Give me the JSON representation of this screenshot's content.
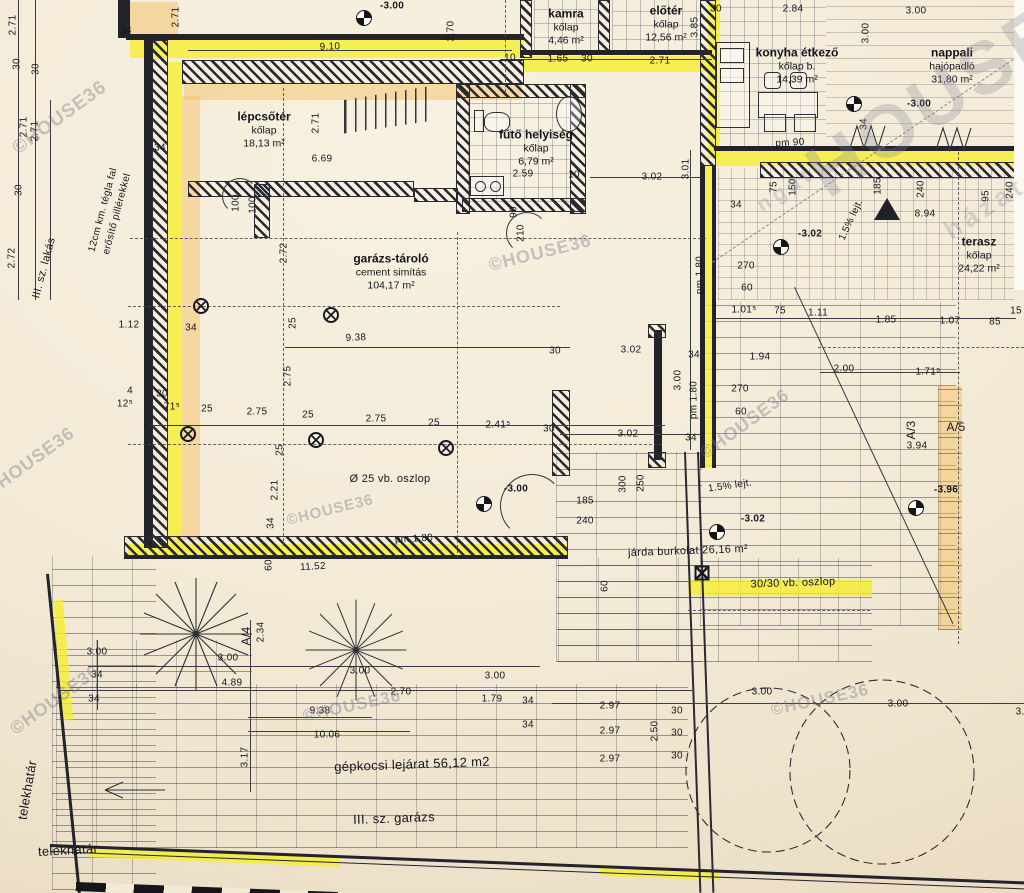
{
  "drawing": {
    "type": "architectural floor plan",
    "watermark_brand": "©HOUSE36",
    "accent_highlight": "#f6ee2c",
    "accent_band": "#f3bc58",
    "paper": "#f3ead6"
  },
  "rooms": [
    {
      "id": "kamra",
      "lines": [
        "kamra",
        "kőlap",
        "4,46 m²"
      ],
      "x": 566,
      "y": 27
    },
    {
      "id": "eloter",
      "lines": [
        "előtér",
        "kőlap",
        "12,56 m²"
      ],
      "x": 666,
      "y": 24
    },
    {
      "id": "konyha",
      "lines": [
        "konyha étkező",
        "kőlap b.",
        "14,39 m²"
      ],
      "x": 797,
      "y": 66
    },
    {
      "id": "nappali",
      "lines": [
        "nappali",
        "hajópadló",
        "31,80 m²"
      ],
      "x": 952,
      "y": 66
    },
    {
      "id": "lepcsoter",
      "lines": [
        "lépcsőtér",
        "kőlap",
        "18,13 m²"
      ],
      "x": 264,
      "y": 130
    },
    {
      "id": "futo",
      "lines": [
        "fűtő helyiség",
        "kőlap",
        "6,79 m²"
      ],
      "x": 536,
      "y": 148
    },
    {
      "id": "garazs",
      "lines": [
        "garázs-tároló",
        "cement simítás",
        "104,17 m²"
      ],
      "x": 391,
      "y": 272
    },
    {
      "id": "terasz",
      "lines": [
        "terasz",
        "kőlap",
        "24,22 m²"
      ],
      "x": 979,
      "y": 255
    }
  ],
  "levels": [
    {
      "t": "-3.00",
      "x": 392,
      "y": 6,
      "mx": 364,
      "my": 18
    },
    {
      "t": "-3.00",
      "x": 919,
      "y": 104,
      "mx": 854,
      "my": 104
    },
    {
      "t": "-3.02",
      "x": 810,
      "y": 234,
      "mx": 781,
      "my": 247
    },
    {
      "t": "-3.00",
      "x": 516,
      "y": 489,
      "mx": 484,
      "my": 504
    },
    {
      "t": "-3.02",
      "x": 753,
      "y": 519,
      "mx": 717,
      "my": 532
    },
    {
      "t": "-3.96",
      "x": 946,
      "y": 490,
      "mx": 916,
      "my": 508
    }
  ],
  "columns_round": [
    [
      201,
      306
    ],
    [
      331,
      315
    ],
    [
      188,
      434
    ],
    [
      316,
      440
    ],
    [
      446,
      448
    ]
  ],
  "columns_square": [
    [
      702,
      573
    ]
  ],
  "dims": [
    {
      "t": "2.71",
      "x": 13,
      "y": 25,
      "r": -90
    },
    {
      "t": "30",
      "x": 17,
      "y": 64,
      "r": -90
    },
    {
      "t": "30",
      "x": 36,
      "y": 69,
      "r": -90
    },
    {
      "t": "2.71",
      "x": 24,
      "y": 127,
      "r": -90
    },
    {
      "t": "2.71",
      "x": 35,
      "y": 131,
      "r": -90
    },
    {
      "t": "30",
      "x": 19,
      "y": 190,
      "r": -90
    },
    {
      "t": "2.72",
      "x": 12,
      "y": 258,
      "r": -90
    },
    {
      "t": "34",
      "x": 126,
      "y": 31
    },
    {
      "t": "2.71",
      "x": 176,
      "y": 17,
      "r": -90
    },
    {
      "t": "9.10",
      "x": 330,
      "y": 47,
      "r": -2
    },
    {
      "t": "2.70",
      "x": 451,
      "y": 31,
      "r": -90
    },
    {
      "t": "10",
      "x": 510,
      "y": 58
    },
    {
      "t": "1.65",
      "x": 558,
      "y": 59
    },
    {
      "t": "30",
      "x": 587,
      "y": 59
    },
    {
      "t": "2.71",
      "x": 660,
      "y": 61
    },
    {
      "t": "3.85",
      "x": 695,
      "y": 27,
      "r": -90
    },
    {
      "t": "30",
      "x": 716,
      "y": 9
    },
    {
      "t": "2.84",
      "x": 793,
      "y": 9
    },
    {
      "t": "3.00",
      "x": 916,
      "y": 11
    },
    {
      "t": "3.00",
      "x": 866,
      "y": 33,
      "r": -90
    },
    {
      "t": "pm 90",
      "x": 790,
      "y": 143,
      "r": -3
    },
    {
      "t": "34",
      "x": 864,
      "y": 124,
      "r": -90
    },
    {
      "t": "185",
      "x": 878,
      "y": 186,
      "r": -90
    },
    {
      "t": "240",
      "x": 921,
      "y": 189,
      "r": -90
    },
    {
      "t": "95",
      "x": 986,
      "y": 196,
      "r": -90
    },
    {
      "t": "240",
      "x": 1010,
      "y": 190,
      "r": -90
    },
    {
      "t": "8.94",
      "x": 925,
      "y": 214
    },
    {
      "t": "3.01",
      "x": 686,
      "y": 169,
      "r": -90
    },
    {
      "t": "75",
      "x": 774,
      "y": 187,
      "r": -90
    },
    {
      "t": "150",
      "x": 793,
      "y": 187,
      "r": -90
    },
    {
      "t": "34",
      "x": 736,
      "y": 205
    },
    {
      "t": "270",
      "x": 746,
      "y": 266
    },
    {
      "t": "60",
      "x": 747,
      "y": 288
    },
    {
      "t": "pm 1.80",
      "x": 700,
      "y": 275,
      "r": -90
    },
    {
      "t": "1.01⁵",
      "x": 744,
      "y": 310
    },
    {
      "t": "75",
      "x": 780,
      "y": 311
    },
    {
      "t": "1.11",
      "x": 818,
      "y": 313
    },
    {
      "t": "1.85",
      "x": 886,
      "y": 320
    },
    {
      "t": "1.07",
      "x": 950,
      "y": 321
    },
    {
      "t": "85",
      "x": 995,
      "y": 322
    },
    {
      "t": "15",
      "x": 1016,
      "y": 311
    },
    {
      "t": "1.94",
      "x": 760,
      "y": 357
    },
    {
      "t": "2.00",
      "x": 844,
      "y": 369
    },
    {
      "t": "1.71⁵",
      "x": 928,
      "y": 372
    },
    {
      "t": "3.02",
      "x": 631,
      "y": 350
    },
    {
      "t": "30",
      "x": 555,
      "y": 351
    },
    {
      "t": "9.38",
      "x": 356,
      "y": 338,
      "r": -2
    },
    {
      "t": "1.12",
      "x": 129,
      "y": 325
    },
    {
      "t": "34",
      "x": 191,
      "y": 328
    },
    {
      "t": "25",
      "x": 293,
      "y": 323,
      "r": -90
    },
    {
      "t": "2.75",
      "x": 288,
      "y": 376,
      "r": -90
    },
    {
      "t": "25",
      "x": 280,
      "y": 450,
      "r": -90
    },
    {
      "t": "2.21",
      "x": 275,
      "y": 490,
      "r": -90
    },
    {
      "t": "34",
      "x": 271,
      "y": 523,
      "r": -90
    },
    {
      "t": "60",
      "x": 269,
      "y": 565,
      "r": -90
    },
    {
      "t": "2.72",
      "x": 284,
      "y": 253,
      "r": -90
    },
    {
      "t": "4",
      "x": 130,
      "y": 391
    },
    {
      "t": "12⁵",
      "x": 125,
      "y": 404
    },
    {
      "t": "30",
      "x": 162,
      "y": 394
    },
    {
      "t": "71⁵",
      "x": 172,
      "y": 407
    },
    {
      "t": "25",
      "x": 207,
      "y": 409
    },
    {
      "t": "2.75",
      "x": 257,
      "y": 412
    },
    {
      "t": "25",
      "x": 308,
      "y": 415
    },
    {
      "t": "2.75",
      "x": 376,
      "y": 419
    },
    {
      "t": "25",
      "x": 434,
      "y": 423
    },
    {
      "t": "2.41⁵",
      "x": 498,
      "y": 425
    },
    {
      "t": "30",
      "x": 549,
      "y": 429
    },
    {
      "t": "3.02",
      "x": 628,
      "y": 434
    },
    {
      "t": "34",
      "x": 691,
      "y": 438
    },
    {
      "t": "34",
      "x": 694,
      "y": 355
    },
    {
      "t": "3.00",
      "x": 678,
      "y": 380,
      "r": -90
    },
    {
      "t": "pm 1.80",
      "x": 694,
      "y": 400,
      "r": -90
    },
    {
      "t": "270",
      "x": 740,
      "y": 389
    },
    {
      "t": "60",
      "x": 741,
      "y": 412
    },
    {
      "t": "3.94",
      "x": 917,
      "y": 446
    },
    {
      "t": "A/3",
      "x": 911,
      "y": 430,
      "r": -90,
      "s": 12
    },
    {
      "t": "A/5",
      "x": 956,
      "y": 427,
      "s": 12
    },
    {
      "t": "185",
      "x": 585,
      "y": 501
    },
    {
      "t": "240",
      "x": 585,
      "y": 521
    },
    {
      "t": "300",
      "x": 623,
      "y": 484,
      "r": -90
    },
    {
      "t": "250",
      "x": 641,
      "y": 483,
      "r": -90
    },
    {
      "t": "pm 1.80",
      "x": 414,
      "y": 539,
      "r": -3
    },
    {
      "t": "11.52",
      "x": 313,
      "y": 567,
      "r": -3
    },
    {
      "t": "60",
      "x": 605,
      "y": 586,
      "r": -90
    },
    {
      "t": "3.00",
      "x": 97,
      "y": 652
    },
    {
      "t": "34",
      "x": 97,
      "y": 675
    },
    {
      "t": "34",
      "x": 94,
      "y": 699
    },
    {
      "t": "3.00",
      "x": 228,
      "y": 658
    },
    {
      "t": "4.89",
      "x": 232,
      "y": 683
    },
    {
      "t": "A/4",
      "x": 246,
      "y": 636,
      "r": -90,
      "s": 12
    },
    {
      "t": "2.34",
      "x": 261,
      "y": 632,
      "r": -90
    },
    {
      "t": "3.17",
      "x": 245,
      "y": 757,
      "r": -90
    },
    {
      "t": "3.00",
      "x": 360,
      "y": 671
    },
    {
      "t": "3.00",
      "x": 495,
      "y": 676
    },
    {
      "t": "2.70",
      "x": 401,
      "y": 692
    },
    {
      "t": "1.79",
      "x": 492,
      "y": 699
    },
    {
      "t": "34",
      "x": 528,
      "y": 701
    },
    {
      "t": "9.38",
      "x": 320,
      "y": 711
    },
    {
      "t": "10.06",
      "x": 327,
      "y": 735
    },
    {
      "t": "34",
      "x": 528,
      "y": 725
    },
    {
      "t": "2.97",
      "x": 610,
      "y": 706
    },
    {
      "t": "2.97",
      "x": 610,
      "y": 731
    },
    {
      "t": "2.97",
      "x": 610,
      "y": 759
    },
    {
      "t": "30",
      "x": 677,
      "y": 711
    },
    {
      "t": "30",
      "x": 677,
      "y": 733
    },
    {
      "t": "30",
      "x": 677,
      "y": 756
    },
    {
      "t": "2.50",
      "x": 655,
      "y": 731,
      "r": -90
    },
    {
      "t": "3.00",
      "x": 762,
      "y": 692
    },
    {
      "t": "3.00",
      "x": 898,
      "y": 704
    },
    {
      "t": "3.00",
      "x": 1026,
      "y": 712
    },
    {
      "t": "6.69",
      "x": 322,
      "y": 159
    },
    {
      "t": "2.71",
      "x": 316,
      "y": 123,
      "r": -90
    },
    {
      "t": "3.02",
      "x": 652,
      "y": 177
    },
    {
      "t": "2.59",
      "x": 523,
      "y": 174
    },
    {
      "t": "10",
      "x": 574,
      "y": 175
    },
    {
      "t": "90",
      "x": 514,
      "y": 212,
      "r": -90
    },
    {
      "t": "210",
      "x": 521,
      "y": 233,
      "r": -90
    },
    {
      "t": "100",
      "x": 236,
      "y": 203,
      "r": -90
    },
    {
      "t": "100",
      "x": 253,
      "y": 205,
      "r": -90
    },
    {
      "t": "34",
      "x": 160,
      "y": 148
    },
    {
      "t": "Ø 25 vb. oszlop",
      "x": 390,
      "y": 479,
      "cls": "lab"
    },
    {
      "t": "járda burkolat 26,16 m²",
      "x": 688,
      "y": 551,
      "r": -2,
      "cls": "lab"
    },
    {
      "t": "30/30 vb. oszlop",
      "x": 793,
      "y": 583,
      "r": -2,
      "cls": "lab"
    },
    {
      "t": "gépkocsi lejárat 56,12 m2",
      "x": 412,
      "y": 764,
      "r": -2,
      "cls": "lab",
      "s": 13
    },
    {
      "t": "III. sz. garázs",
      "x": 394,
      "y": 818,
      "r": -2,
      "cls": "lab",
      "s": 13
    },
    {
      "t": "telekhatár",
      "x": 68,
      "y": 850,
      "r": -3,
      "cls": "lab",
      "s": 13
    },
    {
      "t": "telekhatár",
      "x": 27,
      "y": 790,
      "r": -80,
      "cls": "lab",
      "s": 13
    },
    {
      "t": "III. sz. lakás",
      "x": 44,
      "y": 268,
      "r": -75,
      "cls": "lab"
    },
    {
      "t": "12cm km. tégla fal",
      "x": 103,
      "y": 210,
      "r": -75,
      "s": 10
    },
    {
      "t": "erősítő pillérekkel",
      "x": 117,
      "y": 214,
      "r": -75,
      "s": 10
    },
    {
      "t": "1.5% lejt.",
      "x": 730,
      "y": 486,
      "r": -8
    },
    {
      "t": "1.5% lejt.",
      "x": 851,
      "y": 220,
      "r": -65
    }
  ],
  "watermarks": [
    {
      "t": "©HOUSE36",
      "x": 60,
      "y": 118,
      "r": -36,
      "s": 19
    },
    {
      "t": "©HOUSE36",
      "x": 30,
      "y": 462,
      "r": -36,
      "s": 18
    },
    {
      "t": "©HOUSE36",
      "x": 540,
      "y": 253,
      "r": -14,
      "s": 18
    },
    {
      "t": "©HOUSE36",
      "x": 330,
      "y": 510,
      "r": -14,
      "s": 15
    },
    {
      "t": "©HOUSE36",
      "x": 55,
      "y": 700,
      "r": -36,
      "s": 18
    },
    {
      "t": "©HOUSE36",
      "x": 352,
      "y": 706,
      "r": -12,
      "s": 17
    },
    {
      "t": "©HOUSE36",
      "x": 820,
      "y": 700,
      "r": -12,
      "s": 17
    },
    {
      "t": "©HOUSE36",
      "x": 745,
      "y": 424,
      "r": -36,
      "s": 18
    },
    {
      "t": "HOUSE",
      "x": 935,
      "y": 100,
      "r": -33,
      "s": 74,
      "b": 1
    },
    {
      "t": "házat",
      "x": 985,
      "y": 208,
      "r": -33,
      "s": 26,
      "b": 1
    },
    {
      "t": "ngat",
      "x": 786,
      "y": 190,
      "r": -33,
      "s": 21,
      "b": 1
    }
  ]
}
